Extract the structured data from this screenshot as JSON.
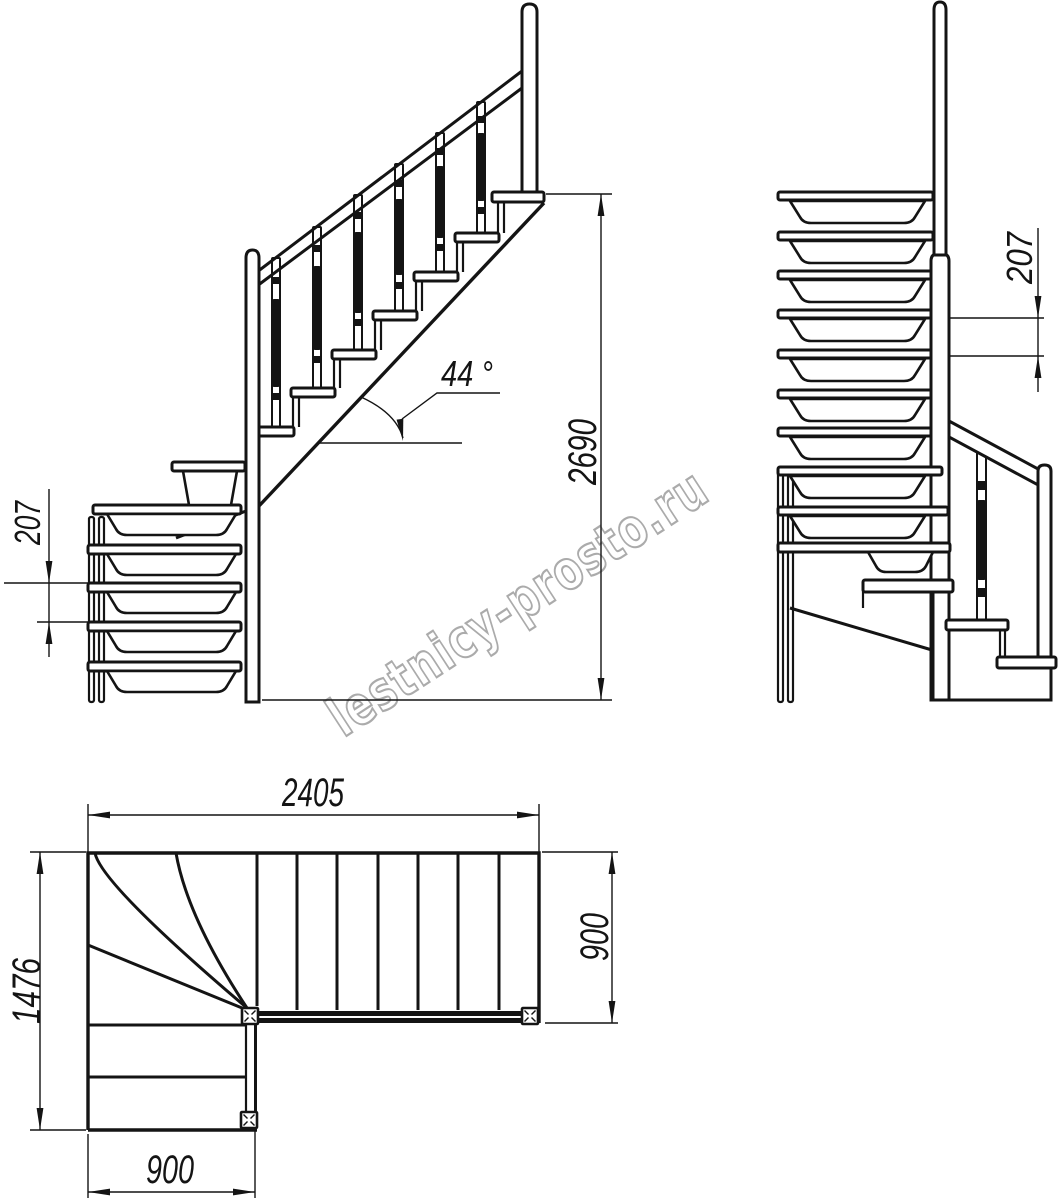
{
  "watermark": {
    "text": "lestnicy-prosto.ru",
    "color": "#ababab"
  },
  "colors": {
    "line": "#141414",
    "background": "#ffffff",
    "watermark": "#ababab"
  },
  "side_view": {
    "rise_mm": "207",
    "total_height_mm": "2690",
    "angle_deg": "44 °"
  },
  "front_view": {
    "rise_mm": "207"
  },
  "plan_view": {
    "total_run_mm": "2405",
    "total_depth_mm": "1476",
    "flight_width_mm": "900",
    "lower_flight_width_mm": "900"
  }
}
